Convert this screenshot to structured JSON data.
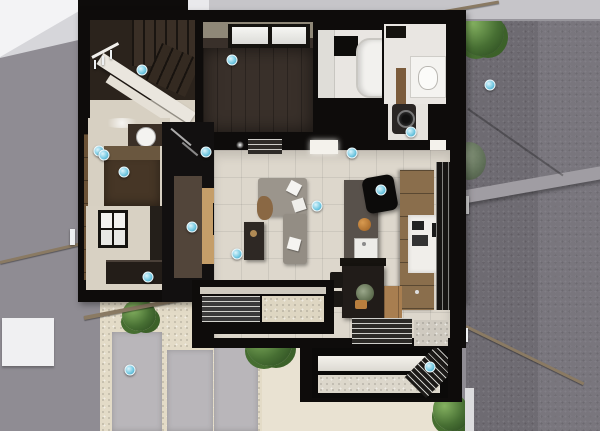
{
  "scene": {
    "title": "Top-down 3D dollhouse render of a small modern house floor plan",
    "view": "overhead cutaway architectural rendering",
    "rooms": [
      {
        "id": "staircase",
        "label": "U-turn staircase with white stringer and handrail"
      },
      {
        "id": "bedroom",
        "label": "Dark wood-floor room with high window"
      },
      {
        "id": "bathroom",
        "label": "Unit bathroom with tub and black window"
      },
      {
        "id": "laundry",
        "label": "Washroom with vanity and front-load washer"
      },
      {
        "id": "hallway",
        "label": "Hallway with round washbasin and dark cabinet"
      },
      {
        "id": "entry",
        "label": "Entry room with paned window and shoe bench"
      },
      {
        "id": "living",
        "label": "Living room with L-shaped gray sofa and media wall"
      },
      {
        "id": "kitchen",
        "label": "Kitchen with stone island, wood cabinets and dark dining table"
      },
      {
        "id": "bay",
        "label": "Louvered garden bay window with gravel bed"
      },
      {
        "id": "sunroom",
        "label": "Glazed sunroom terrace at lower right"
      }
    ],
    "exterior": [
      {
        "id": "neighbor-roof",
        "label": "Neighboring light-gray roof facets"
      },
      {
        "id": "road",
        "label": "Asphalt road with curb band and sloped handrail"
      },
      {
        "id": "courtyard",
        "label": "Gravel courtyard with concrete slabs and shrubs"
      },
      {
        "id": "handrails",
        "label": "Sloped approach handrails with white posts"
      }
    ],
    "marker_count": 16
  },
  "palette": {
    "wall_black": "#0e0c0b",
    "neighbor_wall": "#8f8c93",
    "roof_light": "#d6d6da",
    "roof_white": "#f3f3f5",
    "fence": "#c6c5c9",
    "road": "#6e6b72",
    "road_light": "#7b7880",
    "curb": "#a09da3",
    "floor_tile": "#ddd7cc",
    "floor_beige": "#d7d0c2",
    "room_white": "#e9e6e2",
    "dark_floor": "#39302a",
    "stair_brown": "#2b231c",
    "wood_dark": "#52453a",
    "wood_mid": "#8a6e4c",
    "wood_light": "#c59e69",
    "gravel": "#e3dbc7",
    "slab": "#b9b6ba",
    "walkway": "#e9e2d2",
    "sofa": "#9b958c",
    "handrail": "#8a7a63",
    "marker": "#6ec6e0",
    "green": "#476f33"
  },
  "markers": [
    {
      "x": 142,
      "y": 70
    },
    {
      "x": 232,
      "y": 60
    },
    {
      "x": 206,
      "y": 152
    },
    {
      "x": 99,
      "y": 151
    },
    {
      "x": 104,
      "y": 155
    },
    {
      "x": 124,
      "y": 172
    },
    {
      "x": 192,
      "y": 227
    },
    {
      "x": 148,
      "y": 277
    },
    {
      "x": 317,
      "y": 206
    },
    {
      "x": 237,
      "y": 254
    },
    {
      "x": 352,
      "y": 153
    },
    {
      "x": 381,
      "y": 190
    },
    {
      "x": 411,
      "y": 132
    },
    {
      "x": 430,
      "y": 367
    },
    {
      "x": 130,
      "y": 370
    },
    {
      "x": 490,
      "y": 85
    }
  ]
}
